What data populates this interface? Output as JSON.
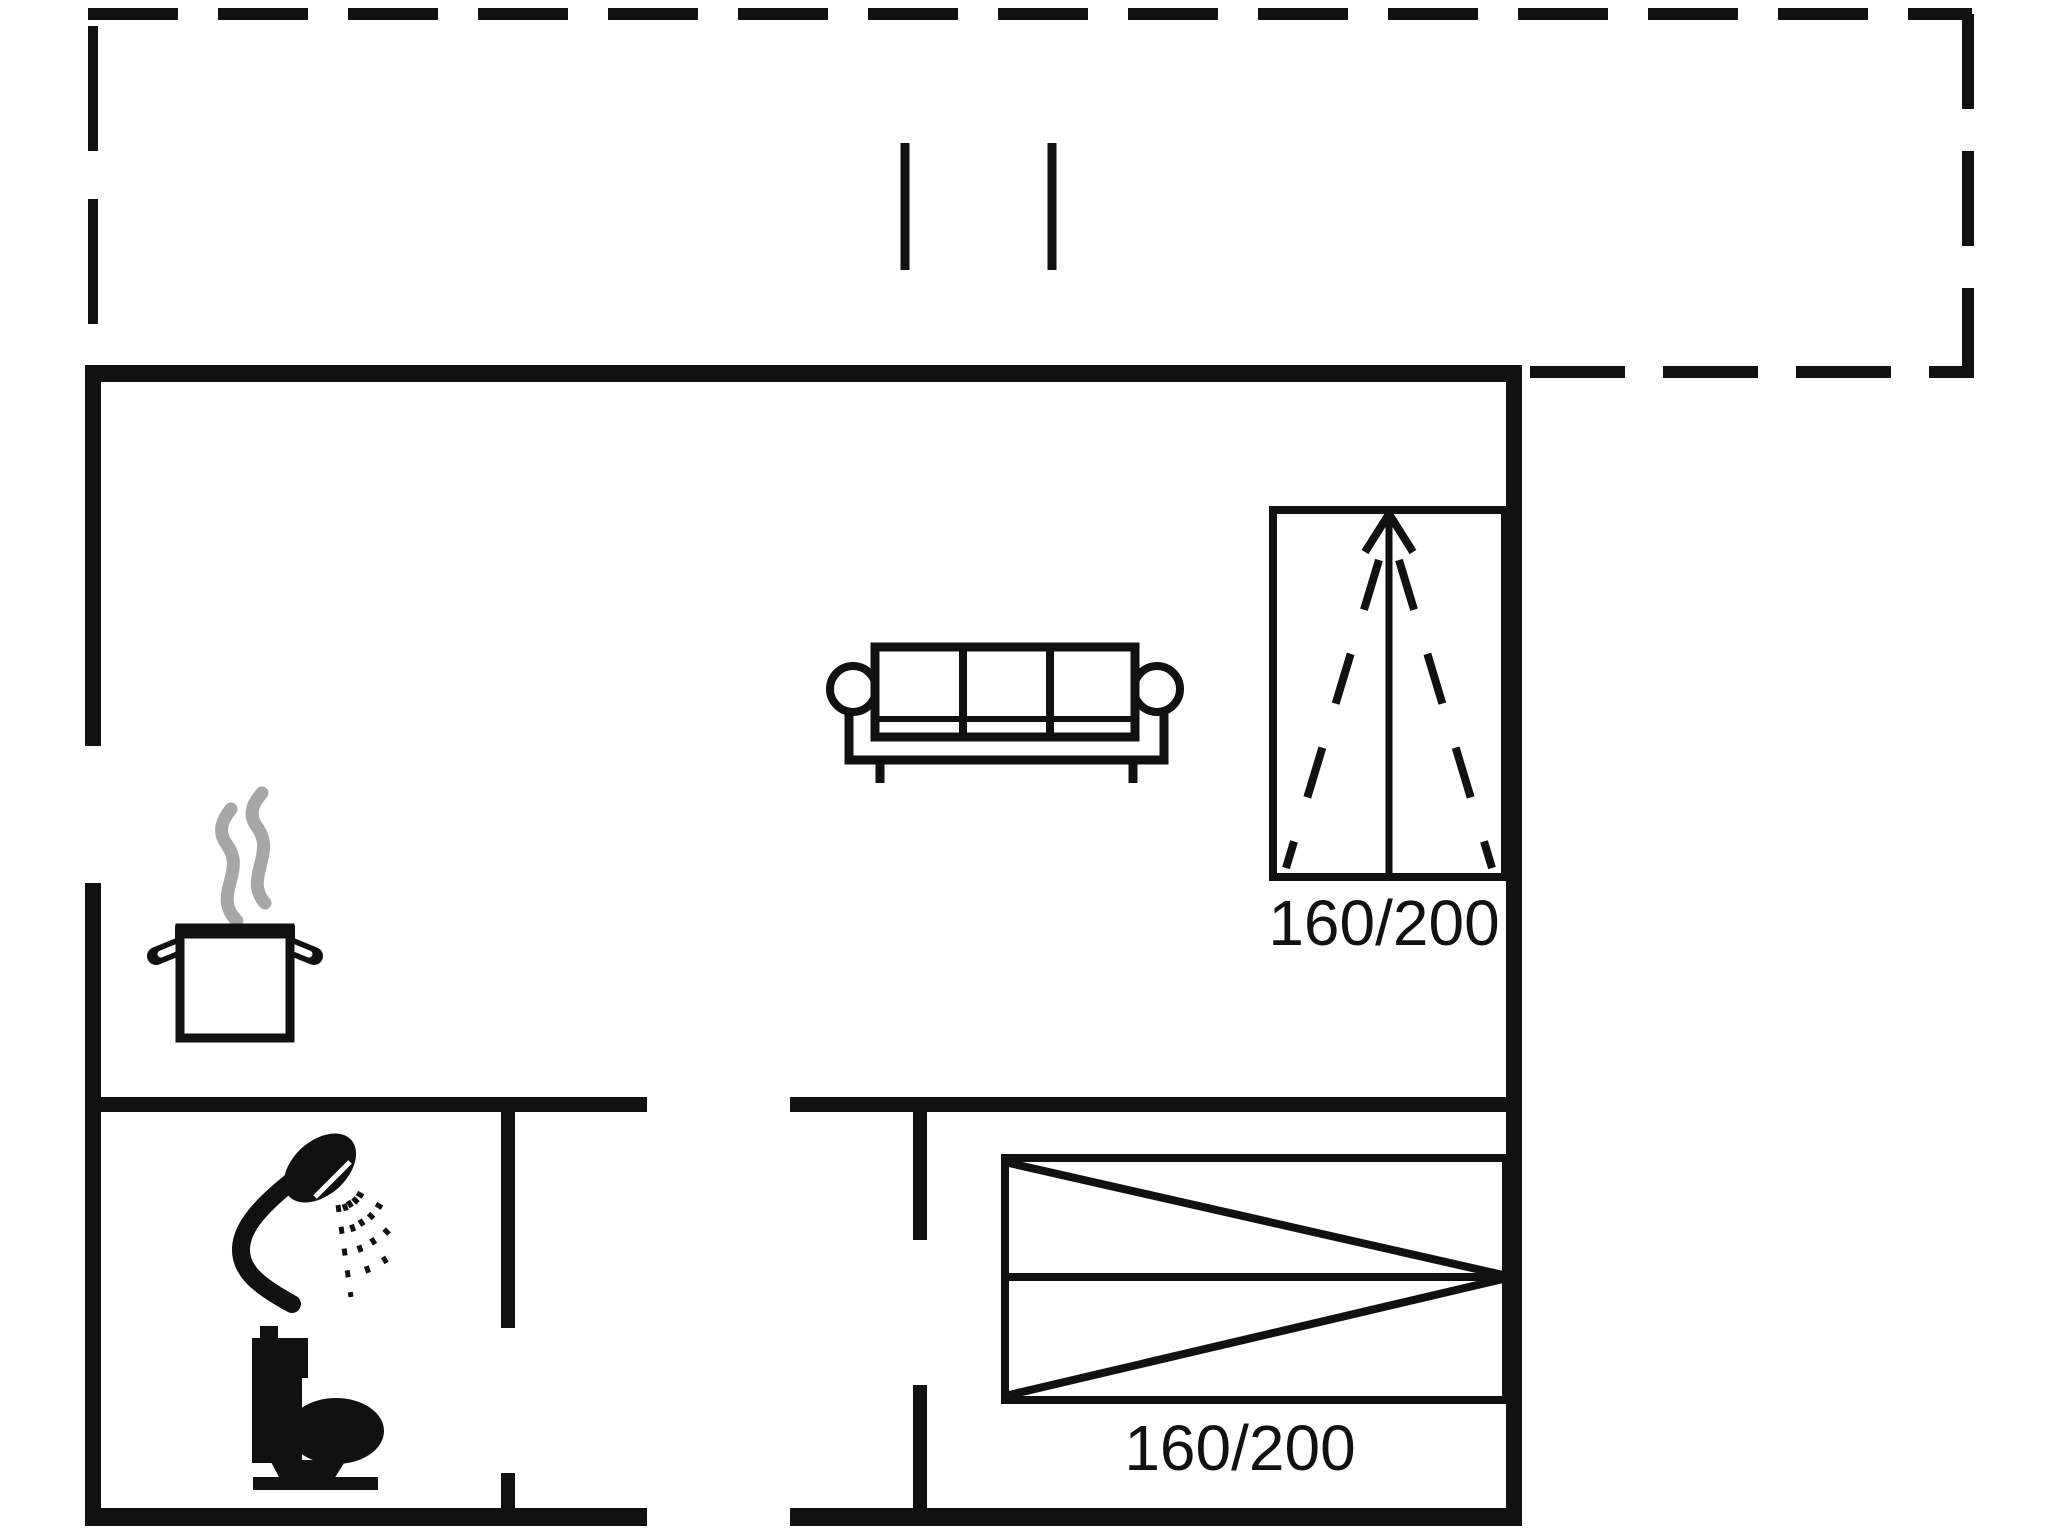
{
  "floor_plan": {
    "background": "#ffffff",
    "line_color": "#111111",
    "steam_color": "#a7a7a7",
    "wardrobe": {
      "size_label": "160/200"
    },
    "bed": {
      "size_label": "160/200"
    },
    "icons": [
      "terrace-dashed-boundary",
      "terrace-door-tick-icon",
      "sofa-icon",
      "wardrobe-icon",
      "wardrobe-arrow-icon",
      "cooking-pot-icon",
      "steam-icon",
      "shower-icon",
      "toilet-icon",
      "double-bed-icon"
    ]
  }
}
